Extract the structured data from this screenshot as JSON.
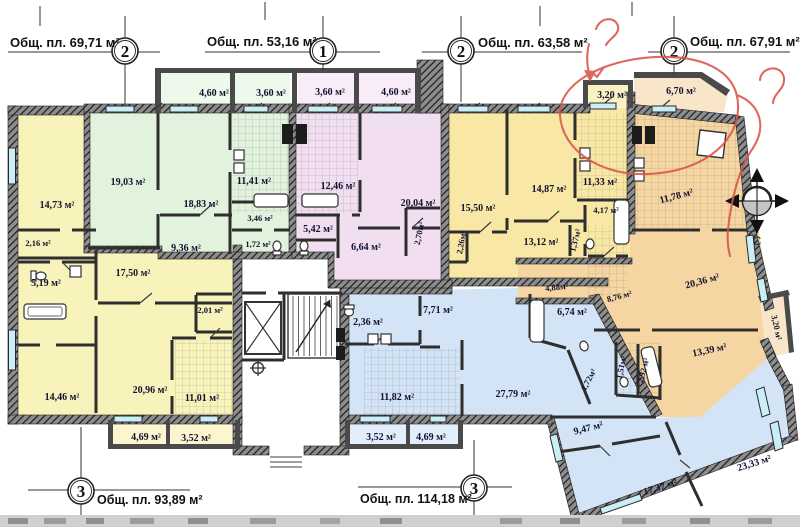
{
  "axes": {
    "top": [
      {
        "num": "2",
        "label": "Общ. пл. 69,71 м²"
      },
      {
        "num": "1",
        "label": "Общ. пл. 53,16 м²"
      },
      {
        "num": "2",
        "label": "Общ. пл. 63,58 м²"
      },
      {
        "num": "2",
        "label": "Общ. пл. 67,91 м²"
      }
    ],
    "bottom": [
      {
        "num": "3",
        "label": "Общ. пл. 93,89 м²"
      },
      {
        "num": "3",
        "label": "Общ. пл. 114,18 м²"
      }
    ]
  },
  "compass": {
    "north_letter": "С"
  },
  "rooms": {
    "green": {
      "balc1": "4,60 м²",
      "balc2": "3,60 м²",
      "r1": "19,03 м²",
      "r2": "18,83 м²",
      "hall": "9,36 м²",
      "kitchen": "11,41 м²",
      "bath": "3,46 м²",
      "wc": "1,72 м²"
    },
    "pink": {
      "balc1": "3,60 м²",
      "balc2": "4,60 м²",
      "kitchen": "12,46 м²",
      "room": "20,04 м²",
      "hall1": "5,42 м²",
      "hall2": "6,64 м²",
      "closet": "2,70м²"
    },
    "left": {
      "r1": "14,73 м²",
      "closet": "2,16 м²",
      "bath": "5,19 м²",
      "hall": "17,50 м²",
      "wc": "2,01 м²",
      "r2": "14,46 м²",
      "r3": "20,96 м²",
      "kitchen": "11,01 м²",
      "balc1": "4,69 м²",
      "balc2": "3,52 м²"
    },
    "mid": {
      "balc": "3,20 м²",
      "r1": "15,50 м²",
      "r2": "14,87 м²",
      "kitchen": "11,33 м²",
      "bath": "4,17 м²",
      "wc": "1,37м²",
      "closet": "2,26м²",
      "r3": "13,12 м²"
    },
    "orange": {
      "balc1": "6,70 м²",
      "kitchen": "11,78 м²",
      "r1": "20,36 м²",
      "hall1": "8,76 м²",
      "hall2": "4,88м²",
      "wc": "1,51м²",
      "bath": "2,92 м²",
      "r2": "13,39 м²",
      "balc2": "3,20 м²"
    },
    "blue": {
      "bath1": "2,36 м²",
      "hall": "7,71 м²",
      "kitchen": "11,82 м²",
      "living": "27,79 м²",
      "bath2": "6,74 м²",
      "wc": "1,72м²",
      "balc1": "3,52 м²",
      "balc2": "4,69 м²",
      "r1": "9,47 м²",
      "r2": "17,37 м²",
      "r3": "23,33 м²"
    }
  },
  "colors": {
    "green": "#e1f3dc",
    "pink": "#f1def1",
    "yellow_left": "#f8f2bb",
    "yellow_mid": "#f9e8a5",
    "orange": "#f5d6a2",
    "blue": "#d2e4f6",
    "window": "#c9eef6",
    "wall": "#3a3a3a",
    "annotation_red": "#d9544a"
  }
}
